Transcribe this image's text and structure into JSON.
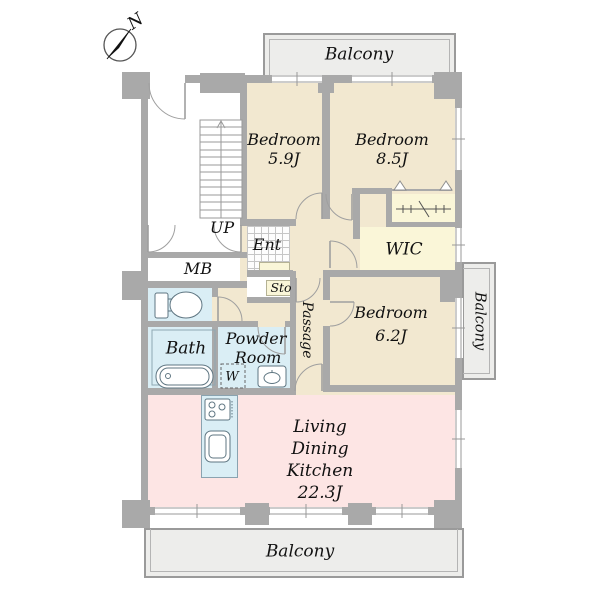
{
  "colors": {
    "wall": "#a9a9a9",
    "floor-beige": "#f2e8d0",
    "floor-yellow": "#faf6d8",
    "floor-blue": "#daeef5",
    "floor-pink": "#fde5e4",
    "balcony": "#ededeb"
  },
  "compass": {
    "north_label": "N"
  },
  "balconies": {
    "top": "Balcony",
    "right": "Balcony",
    "bottom": "Balcony"
  },
  "rooms": {
    "bedroom_1": {
      "name": "Bedroom",
      "size": "5.9J"
    },
    "bedroom_2": {
      "name": "Bedroom",
      "size": "8.5J"
    },
    "bedroom_3": {
      "name": "Bedroom",
      "size": "6.2J"
    },
    "ldk": {
      "line1": "Living",
      "line2": "Dining",
      "line3": "Kitchen",
      "size": "22.3J"
    },
    "wic": {
      "name": "WIC"
    },
    "bath": {
      "name": "Bath"
    },
    "powder_room": {
      "line1": "Powder",
      "line2": "Room",
      "washer": "W"
    },
    "entrance": {
      "name": "Ent"
    },
    "storage": {
      "name": "Sto"
    },
    "passage": {
      "name": "Passage"
    },
    "meter_box": {
      "name": "MB"
    },
    "stairs": {
      "direction": "UP"
    }
  }
}
